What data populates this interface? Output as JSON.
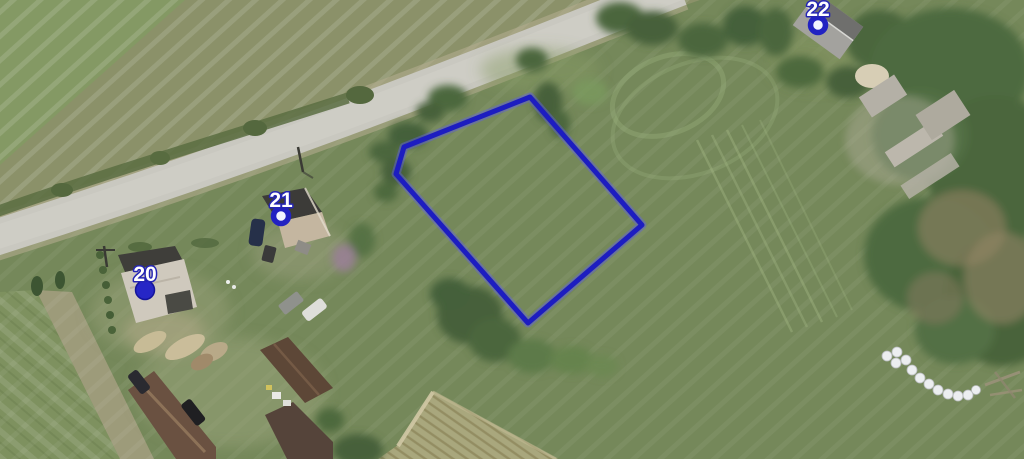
{
  "map": {
    "view_type": "aerial-imagery",
    "accent_color": "#1d1dc0",
    "parcel": {
      "outline_color": "#1d1dc0",
      "points": [
        [
          530,
          97
        ],
        [
          642,
          225
        ],
        [
          528,
          323
        ],
        [
          396,
          174
        ],
        [
          404,
          147
        ]
      ]
    },
    "markers": [
      {
        "label": "20",
        "x": 145,
        "y": 290,
        "style": "filled"
      },
      {
        "label": "21",
        "x": 281,
        "y": 216,
        "style": "ring"
      },
      {
        "label": "22",
        "x": 818,
        "y": 25,
        "style": "ring"
      }
    ]
  }
}
